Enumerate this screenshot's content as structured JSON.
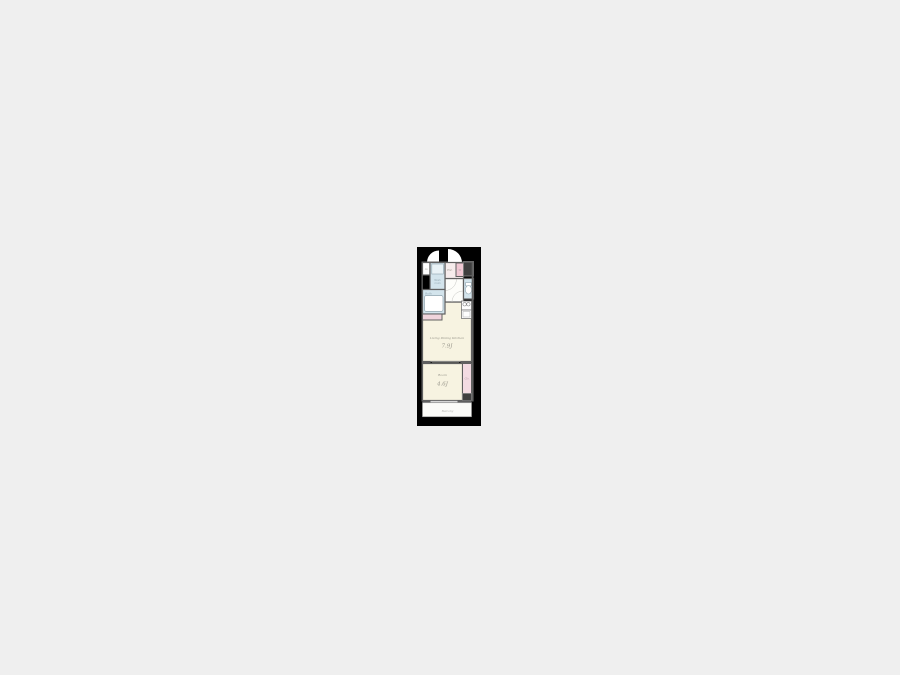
{
  "page": {
    "background_color": "#efefef"
  },
  "floorplan": {
    "type": "japanese-apartment-floor-plan",
    "colors": {
      "plan_background": "#000000",
      "wall": "#606060",
      "floor_main": "#f7f3e1",
      "floor_wet": "#d3e4ec",
      "floor_closet": "#f3dbe2",
      "floor_washer": "#f0c9d4",
      "floor_entrance": "#f6ecec",
      "dark_box": "#3f3f3f"
    },
    "labels": {
      "ldk_name": "Living Dining Kitchen",
      "ldk_size": "7.9J",
      "room_name": "Room",
      "room_size": "4.6J",
      "bath": "Bath",
      "wash_room_line1": "Wash",
      "wash_room_line2": "room",
      "entrance": "Ent.",
      "washer": "W",
      "pipe_space": "PS",
      "closet": "Clo.",
      "balcony": "Balcony"
    }
  }
}
